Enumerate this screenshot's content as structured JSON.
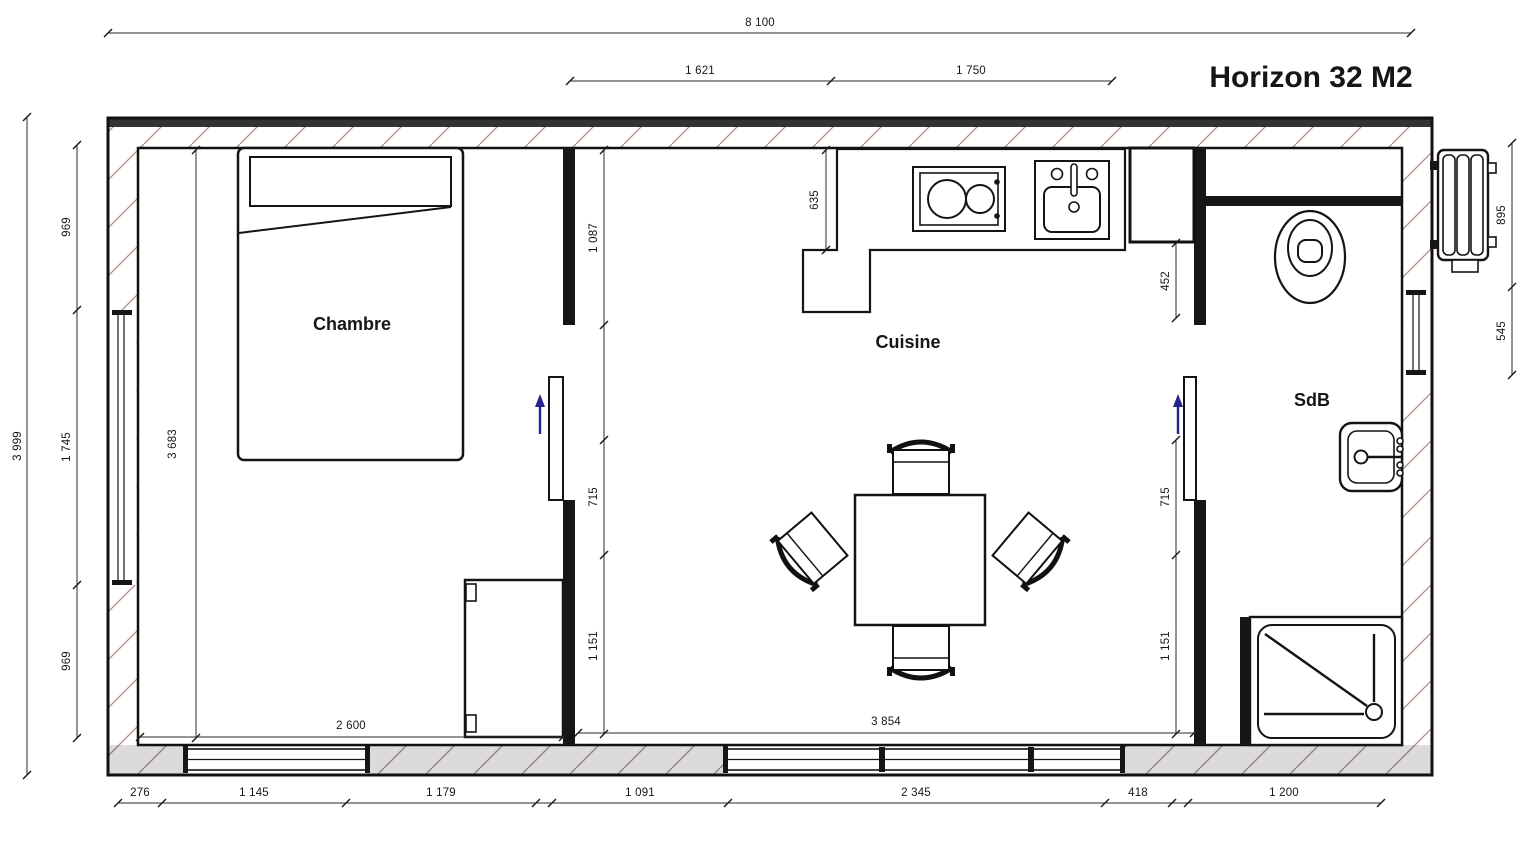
{
  "title": {
    "text": "Horizon 32 M2",
    "color": "#ee3b28"
  },
  "rooms": {
    "bedroom": "Chambre",
    "kitchen": "Cuisine",
    "bathroom": "SdB"
  },
  "dims": {
    "overall_width": "8 100",
    "overall_height": "3 999",
    "top": [
      "1 621",
      "1 750"
    ],
    "left": [
      "969",
      "1 745",
      "969"
    ],
    "right": [
      "895",
      "545"
    ],
    "bottom": [
      "276",
      "1 145",
      "1 179",
      "1 091",
      "2 345",
      "418",
      "1 200"
    ],
    "bedroom": {
      "width": "2 600",
      "height": "3 683"
    },
    "kitchen": {
      "width": "3 854",
      "counter_depth": "635",
      "wall_left": [
        "1 087",
        "715",
        "1 151"
      ],
      "wall_right": [
        "452",
        "715",
        "1 151"
      ]
    }
  },
  "colors": {
    "wall_hatch": "#ab8f80",
    "door_arrow": "#23238e",
    "line": "#141414"
  }
}
